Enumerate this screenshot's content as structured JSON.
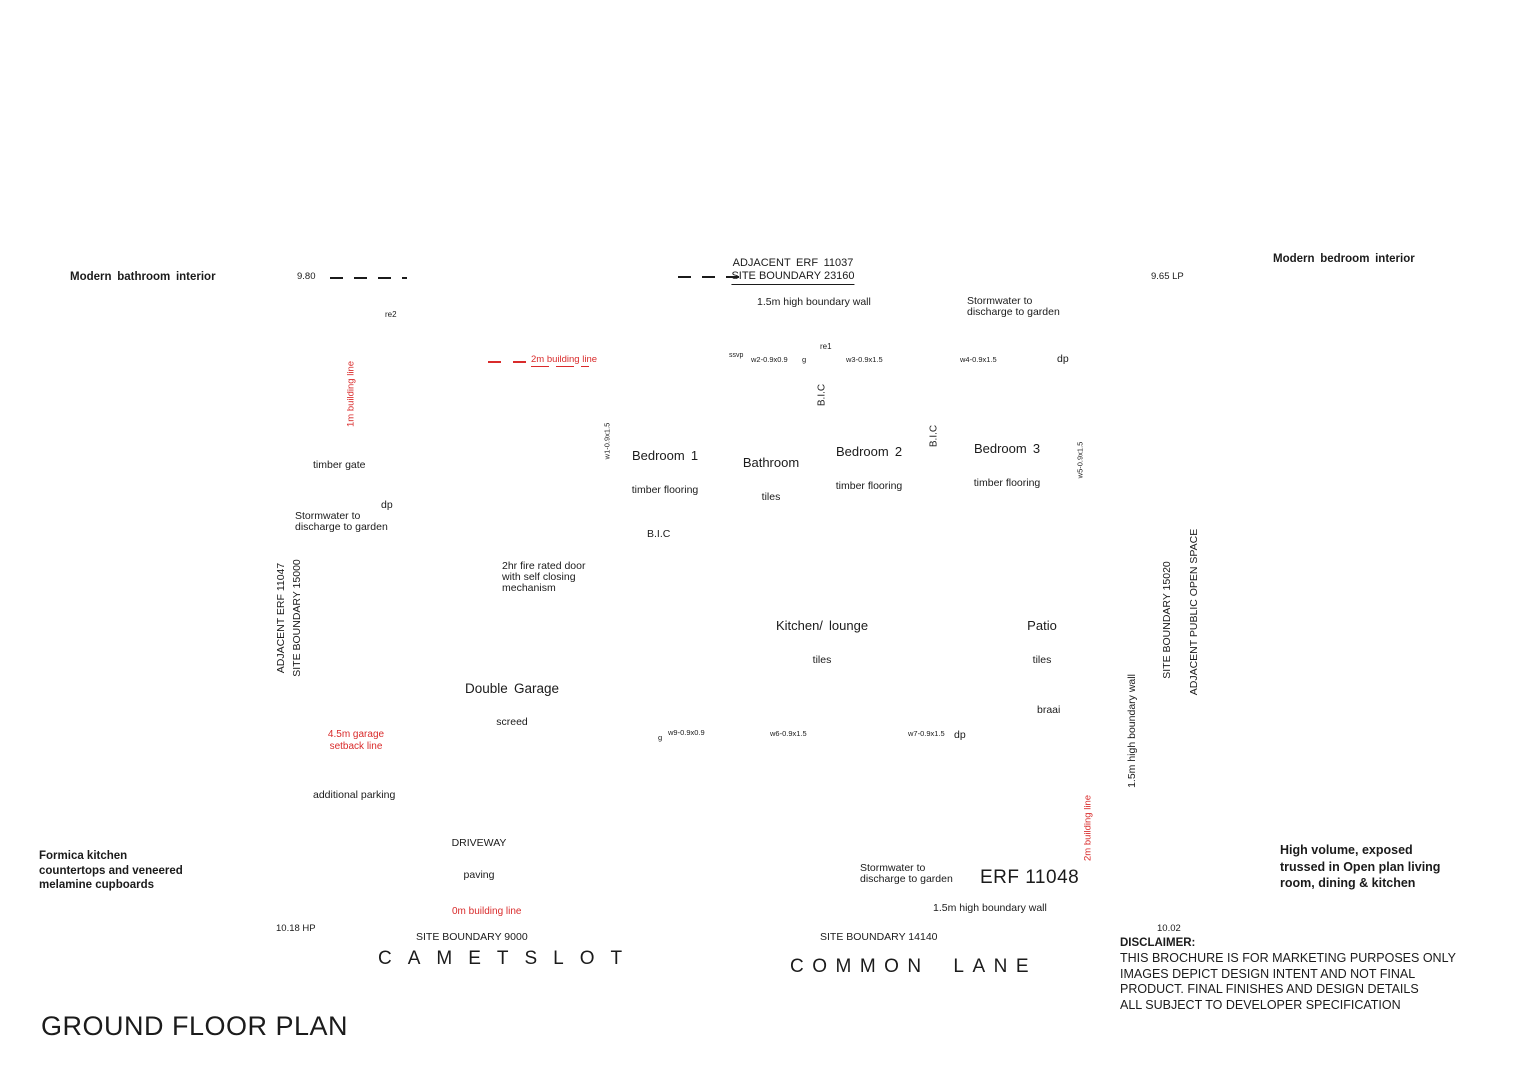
{
  "colors": {
    "ink": "#1b1b1b",
    "red": "#d92b2b",
    "background": "#ffffff"
  },
  "title": "GROUND FLOOR PLAN",
  "erf": "ERF 11048",
  "captions": {
    "bathroom": "Modern bathroom interior",
    "bedroom": "Modern bedroom interior",
    "kitchen": "Formica kitchen\ncountertops and veneered\nmelamine cupboards",
    "living": "High volume, exposed\ntrussed in Open plan living\nroom, dining & kitchen"
  },
  "streets": {
    "left": "CAMETSLOT",
    "right": "COMMON LANE"
  },
  "site_boundaries": {
    "top_adjacent": "ADJACENT ERF 11037",
    "top": "SITE BOUNDARY 23160",
    "left_adjacent": "ADJACENT ERF 11047",
    "left": "SITE BOUNDARY 15000",
    "right": "SITE BOUNDARY 15020",
    "right_adjacent": "ADJACENT PUBLIC OPEN SPACE",
    "bottom_left": "SITE BOUNDARY 9000",
    "bottom_right": "SITE BOUNDARY 14140"
  },
  "levels": {
    "top_left": "9.80",
    "top_right": "9.65 LP",
    "bottom_left": "10.18 HP",
    "bottom_right": "10.02"
  },
  "building_lines": {
    "one_m": "1m building line",
    "two_m_top": "2m building line",
    "two_m_right": "2m building line",
    "zero_m": "0m building line",
    "garage_setback": "4.5m garage\nsetback line"
  },
  "boundary_walls": {
    "top": "1.5m high boundary wall",
    "right": "1.5m high boundary wall",
    "bottom": "1.5m high boundary wall"
  },
  "rooms": {
    "bedroom1": {
      "name": "Bedroom 1",
      "finish": "timber flooring"
    },
    "bathroom": {
      "name": "Bathroom",
      "finish": "tiles"
    },
    "bedroom2": {
      "name": "Bedroom 2",
      "finish": "timber flooring"
    },
    "bedroom3": {
      "name": "Bedroom 3",
      "finish": "timber flooring"
    },
    "kitchen_lounge": {
      "name": "Kitchen/ lounge",
      "finish": "tiles"
    },
    "patio": {
      "name": "Patio",
      "finish": "tiles"
    },
    "garage": {
      "name": "Double Garage",
      "finish": "screed"
    },
    "driveway": {
      "name": "DRIVEWAY",
      "finish": "paving"
    }
  },
  "notes": {
    "stormwater": "Stormwater to\ndischarge to garden",
    "fire_door": "2hr fire rated door\nwith self closing\nmechanism",
    "timber_gate": "timber gate",
    "additional_parking": "additional parking",
    "braai": "braai",
    "bic": "B.I.C"
  },
  "fixtures": {
    "w1": "w1-0.9x1.5",
    "w2": "w2-0.9x0.9",
    "w3": "w3-0.9x1.5",
    "w4": "w4-0.9x1.5",
    "w5": "w5-0.9x1.5",
    "w6": "w6-0.9x1.5",
    "w7": "w7-0.9x1.5",
    "w9": "w9-0.9x0.9",
    "dp": "dp",
    "g": "g",
    "ssvp": "ssvp",
    "re1": "re1",
    "re2": "re2"
  },
  "disclaimer": {
    "heading": "DISCLAIMER:",
    "body": "THIS BROCHURE IS FOR MARKETING PURPOSES ONLY\nIMAGES DEPICT DESIGN INTENT AND NOT FINAL\nPRODUCT. FINAL FINISHES AND DESIGN DETAILS\nALL SUBJECT TO DEVELOPER SPECIFICATION"
  }
}
